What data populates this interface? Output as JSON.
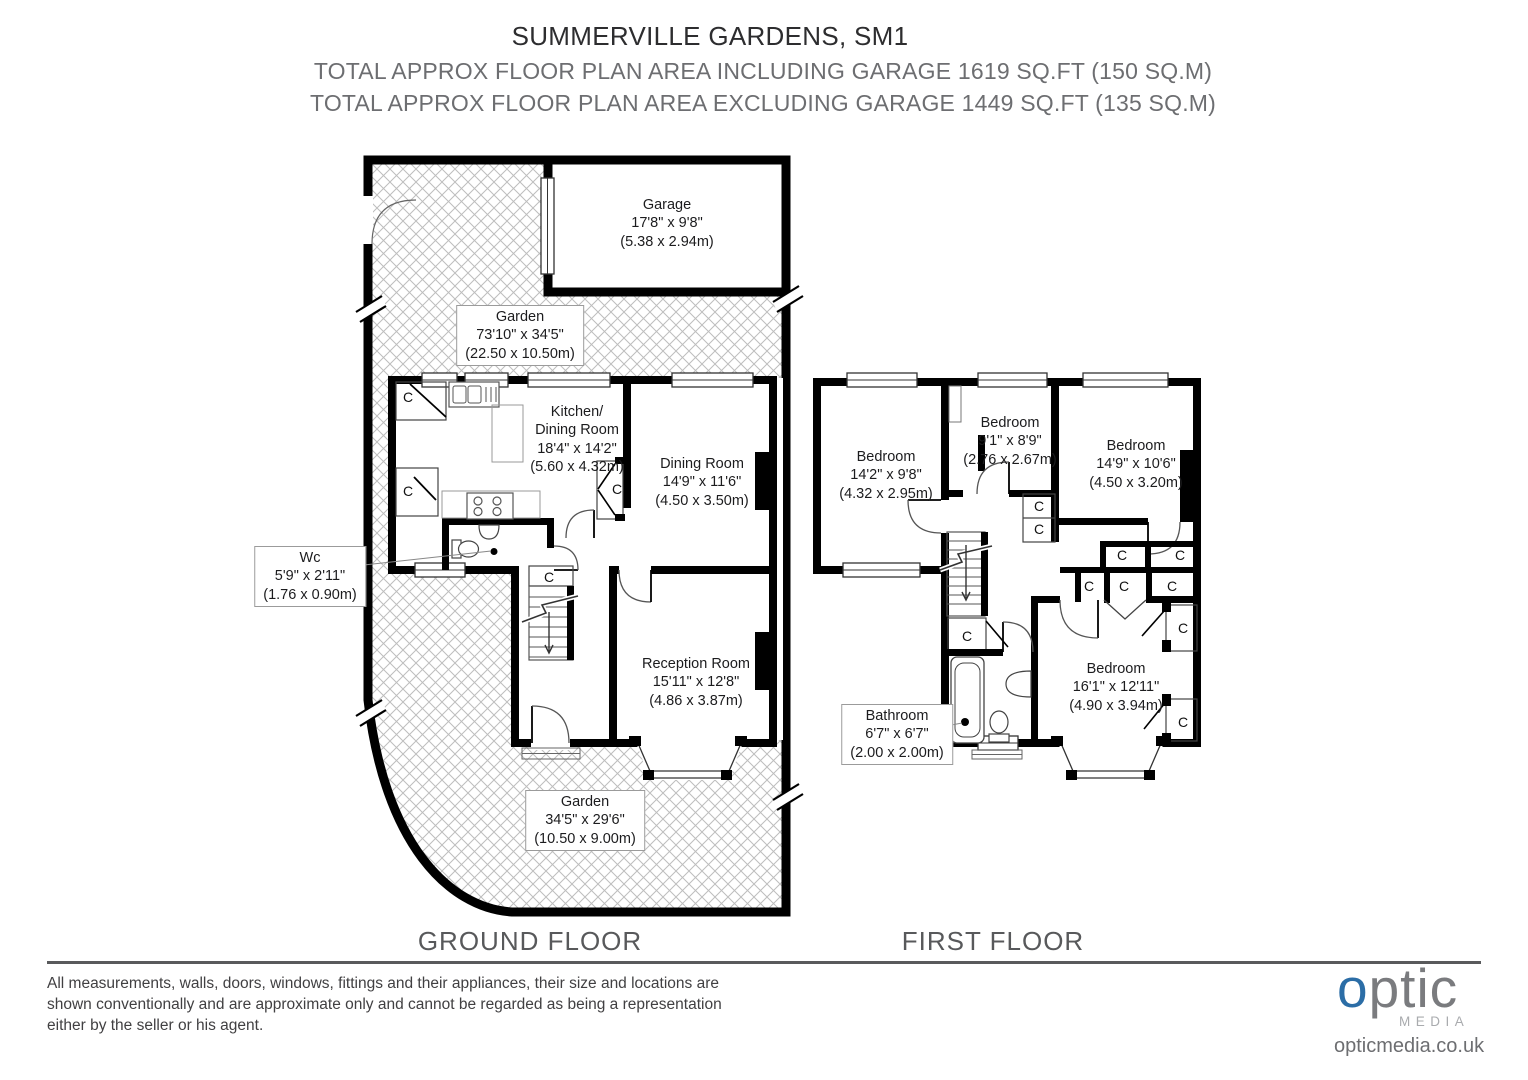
{
  "header": {
    "title": "SUMMERVILLE GARDENS, SM1",
    "line1": "TOTAL APPROX FLOOR PLAN AREA INCLUDING GARAGE 1619 SQ.FT (150 SQ.M)",
    "line2": "TOTAL APPROX FLOOR PLAN AREA EXCLUDING GARAGE 1449 SQ.FT (135 SQ.M)"
  },
  "plan": {
    "closet_label": "C"
  },
  "ground_floor": {
    "label": "GROUND FLOOR",
    "rooms": {
      "garage": {
        "name": "Garage",
        "imperial": "17'8\" x 9'8\"",
        "metric": "(5.38 x 2.94m)"
      },
      "garden_top": {
        "name": "Garden",
        "imperial": "73'10\" x 34'5\"",
        "metric": "(22.50 x 10.50m)"
      },
      "kitchen": {
        "name1": "Kitchen/",
        "name2": "Dining Room",
        "imperial": "18'4\" x 14'2\"",
        "metric": "(5.60 x 4.32m)"
      },
      "dining": {
        "name": "Dining Room",
        "imperial": "14'9\" x 11'6\"",
        "metric": "(4.50 x 3.50m)"
      },
      "wc": {
        "name": "Wc",
        "imperial": "5'9\" x 2'11\"",
        "metric": "(1.76 x 0.90m)"
      },
      "reception": {
        "name": "Reception Room",
        "imperial": "15'11\" x 12'8\"",
        "metric": "(4.86 x 3.87m)"
      },
      "garden_bottom": {
        "name": "Garden",
        "imperial": "34'5\" x 29'6\"",
        "metric": "(10.50 x 9.00m)"
      }
    }
  },
  "first_floor": {
    "label": "FIRST FLOOR",
    "rooms": {
      "bedroom1": {
        "name": "Bedroom",
        "imperial": "14'2\" x 9'8\"",
        "metric": "(4.32 x 2.95m)"
      },
      "bedroom2": {
        "name": "Bedroom",
        "imperial": "9'1\" x 8'9\"",
        "metric": "(2.76 x 2.67m)"
      },
      "bedroom3": {
        "name": "Bedroom",
        "imperial": "14'9\" x 10'6\"",
        "metric": "(4.50 x 3.20m)"
      },
      "bedroom4": {
        "name": "Bedroom",
        "imperial": "16'1\" x 12'11\"",
        "metric": "(4.90 x 3.94m)"
      },
      "bathroom": {
        "name": "Bathroom",
        "imperial": "6'7\" x 6'7\"",
        "metric": "(2.00 x 2.00m)"
      }
    }
  },
  "footer": {
    "disclaimer_line1": "All measurements, walls, doors, windows, fittings and their appliances, their size and locations are",
    "disclaimer_line2": "shown conventionally and are approximate only and cannot be regarded as being a representation",
    "disclaimer_line3": "either by the seller or his agent.",
    "logo": {
      "word_o": "o",
      "word_rest": "ptic",
      "sub": "MEDIA",
      "url": "opticmedia.co.uk"
    },
    "colors": {
      "logo_blue": "#2b6da6",
      "logo_gray": "#7a7b7e"
    }
  }
}
